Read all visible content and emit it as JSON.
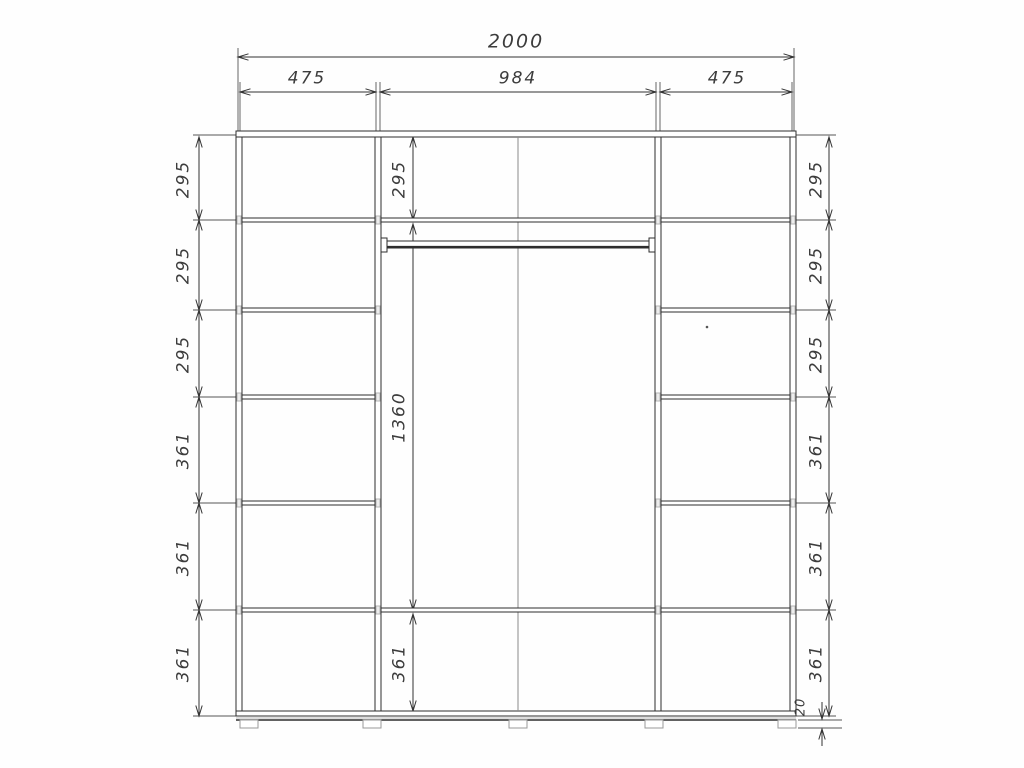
{
  "drawing": {
    "overall_width": "2000",
    "top_sections": [
      "475",
      "984",
      "475"
    ],
    "left_column": [
      "295",
      "295",
      "295",
      "361",
      "361",
      "361"
    ],
    "center_column": [
      "295",
      "1360",
      "361"
    ],
    "right_column": [
      "295",
      "295",
      "295",
      "361",
      "361",
      "361"
    ],
    "base_height": "20"
  }
}
